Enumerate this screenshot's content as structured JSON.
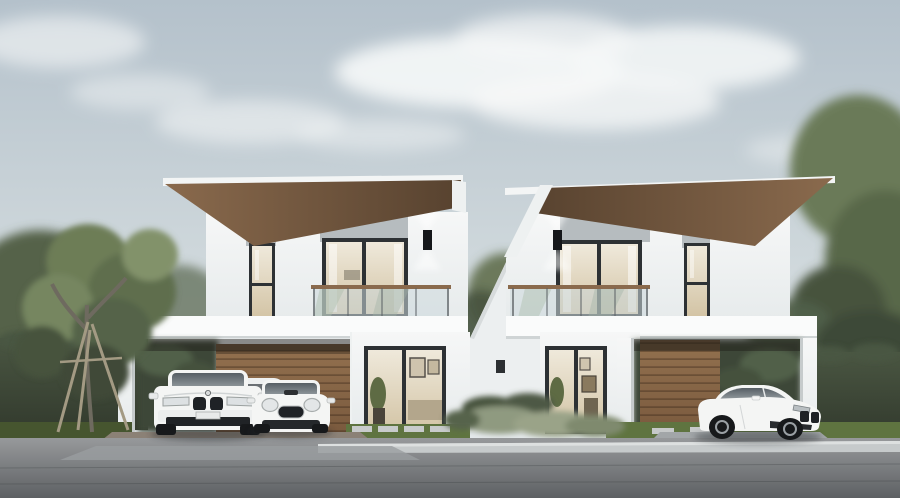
{
  "scene": {
    "title": "Twin modern two-storey houses with carports and white cars",
    "description": "Photorealistic exterior rendering of two mirrored modern two-storey houses under a pale overcast sky. Each house has a cantilevered flat skillion roof with a timber soffit, an upper-floor balcony with a glass railing and timber handrail behind a full-height sliding glass door, a tall narrow side window, grey accent panels, a lit black up/down wall sconce, a ground-floor glass entrance door and a timber slat feature wall inside a white carport frame. A white SUV and a white Mini-style hatchback are parked in the left carport with another white car partially visible behind them; a white luxury coupe is parked in the right carport. A young tree supported by timber stakes stands at the left, tall clipped hedges and large trees flank both sides, sage-green shrubs sit between the houses, and lawn strips with concrete pavers meet a wide grey street with a light curb in the foreground.",
    "sky": "pale blue-grey sky with soft white clouds",
    "lighting": "soft overcast daylight",
    "buildings": [
      {
        "name": "left house",
        "storeys": 2,
        "roof": "cantilevered skillion roof, timber soffit, overhang to the left",
        "features": [
          "balcony with glass railing and timber cap",
          "sliding glass balcony door",
          "tall narrow window",
          "grey accent panels",
          "black wall sconce lit up and down",
          "glass entrance door with warm interior",
          "timber slat carport wall",
          "white carport frame"
        ]
      },
      {
        "name": "right house",
        "storeys": 2,
        "roof": "cantilevered skillion roof, timber soffit, overhang to the right (mirror of left house)",
        "features": [
          "balcony with glass railing and timber cap",
          "sliding glass balcony door",
          "tall narrow window",
          "grey accent panels",
          "black wall sconce lit up and down",
          "glass entrance door with shelves visible inside",
          "timber slat carport wall",
          "white carport frame"
        ]
      }
    ],
    "middle_structure": "white connecting wall between the houses with a tall narrow black window and a small vent",
    "vehicles": [
      {
        "type": "luxury SUV",
        "color": "white",
        "location": "left carport",
        "view": "front"
      },
      {
        "type": "compact Mini-style hatchback",
        "color": "white",
        "location": "left carport",
        "view": "front"
      },
      {
        "type": "car partially visible",
        "color": "white",
        "location": "behind the vehicles in the left carport"
      },
      {
        "type": "luxury coupe",
        "color": "white",
        "location": "right carport",
        "view": "three-quarter front"
      }
    ],
    "landscape": [
      "young tree with timber support stakes on the left lawn",
      "tall clipped hedge fences on both sides",
      "large leafy trees behind the hedges and at the right edge",
      "sage-green low shrubs between the houses",
      "lawn strips with concrete stepping pavers"
    ],
    "road": "wide grey paved street with a light concrete curb across the foreground"
  },
  "colors": {
    "sky_top": "#b4c1cb",
    "sky_bottom": "#e7ebed",
    "cloud": "#f6f8f8",
    "wall_top": "#f6f7f7",
    "wall_bottom": "#e7ebec",
    "slab": "#fafbfb",
    "panel_gray": "#b6bcbf",
    "soffit_light": "#8a6a4d",
    "soffit_dark": "#57422f",
    "wood_light": "#93714f",
    "wood_dark": "#7a5a3e",
    "frame_dark": "#2d3134",
    "glass_warm_top": "#efe9db",
    "glass_warm_bottom": "#d3c4a5",
    "glass_cool": "#ccd9dd",
    "hedge_top": "#4a5642",
    "hedge_bottom": "#333b2e",
    "tree_dark": "#47533e",
    "tree_mid": "#5f6e4e",
    "tree_light": "#82926a",
    "grass": "#5f7440",
    "grass_dark": "#46552f",
    "road_top": "#97999b",
    "road_bottom": "#5d6063",
    "curb": "#c6cacb",
    "drive_pavers": "#8b8176",
    "apron": "#a2a6a8",
    "car_white": "#f4f5f4",
    "car_glass_top": "#565e64",
    "car_glass_bottom": "#9aa2a6",
    "grille": "#1f2226",
    "wheel": "#17191b",
    "sconce": "#15171a"
  }
}
